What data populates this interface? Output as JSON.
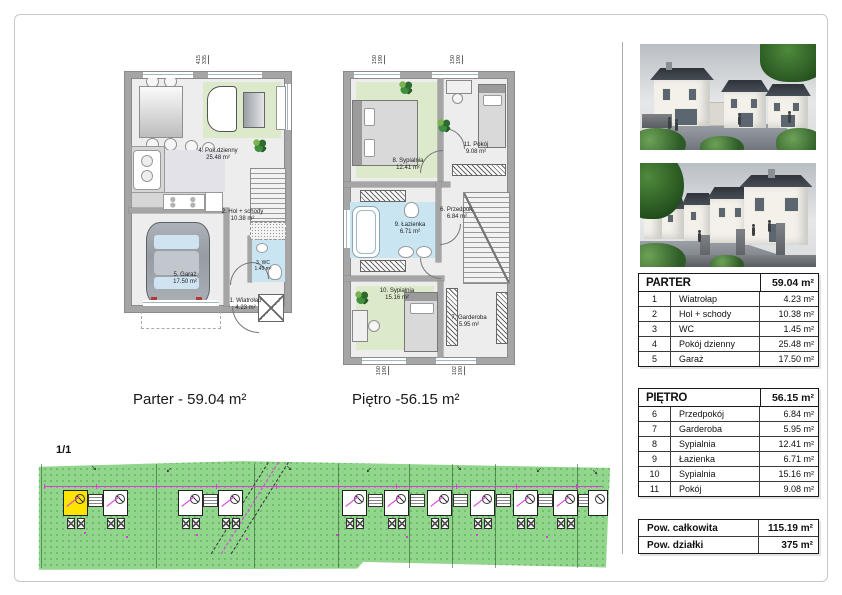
{
  "captions": {
    "parter": "Parter - 59.04 m²",
    "pietro": "Piętro -56.15 m²"
  },
  "site_plan": {
    "sheet_label": "1/1"
  },
  "plan_labels": {
    "parter": [
      {
        "name": "4. Pok.dzienny",
        "area": "25.48 m²"
      },
      {
        "name": "2. Hol + schody",
        "area": "10.38 m²"
      },
      {
        "name": "3. WC",
        "area": "1.45 m²"
      },
      {
        "name": "5. Garaż",
        "area": "17.50 m²"
      },
      {
        "name": "1. Wiatrołap",
        "area": "4.23 m²"
      }
    ],
    "pietro": [
      {
        "name": "8. Sypialnia",
        "area": "12.41 m²"
      },
      {
        "name": "11. Pokój",
        "area": "9.08 m²"
      },
      {
        "name": "9. Łazienka",
        "area": "6.71 m²"
      },
      {
        "name": "6. Przedpok.",
        "area": "6.84 m²"
      },
      {
        "name": "10. Sypialnia",
        "area": "15.16 m²"
      },
      {
        "name": "7. Garderoba",
        "area": "5.95 m²"
      }
    ]
  },
  "dimensions": {
    "parter_top": {
      "a": "415",
      "b": "335"
    },
    "pietro_top_1": {
      "a": "150",
      "b": "190"
    },
    "pietro_top_2": {
      "a": "150",
      "b": "190"
    },
    "pietro_bottom_1": {
      "a": "150",
      "b": "190"
    },
    "pietro_bottom_2": {
      "a": "102",
      "b": "190"
    }
  },
  "tables": {
    "parter": {
      "title": "PARTER",
      "total": "59.04 m²",
      "rows": [
        {
          "no": "1",
          "name": "Wiatrołap",
          "area": "4.23 m²"
        },
        {
          "no": "2",
          "name": "Hol + schody",
          "area": "10.38 m²"
        },
        {
          "no": "3",
          "name": "WC",
          "area": "1.45 m²"
        },
        {
          "no": "4",
          "name": "Pokój dzienny",
          "area": "25.48 m²"
        },
        {
          "no": "5",
          "name": "Garaż",
          "area": "17.50 m²"
        }
      ]
    },
    "pietro": {
      "title": "PIĘTRO",
      "total": "56.15 m²",
      "rows": [
        {
          "no": "6",
          "name": "Przedpokój",
          "area": "6.84 m²"
        },
        {
          "no": "7",
          "name": "Garderoba",
          "area": "5.95 m²"
        },
        {
          "no": "8",
          "name": "Sypialnia",
          "area": "12.41 m²"
        },
        {
          "no": "9",
          "name": "Łazienka",
          "area": "6.71 m²"
        },
        {
          "no": "10",
          "name": "Sypialnia",
          "area": "15.16 m²"
        },
        {
          "no": "11",
          "name": "Pokój",
          "area": "9.08 m²"
        }
      ]
    },
    "summary": {
      "rows": [
        {
          "name": "Pow. całkowita",
          "area": "115.19 m²"
        },
        {
          "name": "Pow. działki",
          "area": "375 m²"
        }
      ]
    }
  },
  "colors": {
    "site_green": "#92d68e",
    "highlight_yellow": "#ffe400",
    "annotation_magenta": "#e03ae0",
    "bath_blue": "#c9e5f2",
    "rug_green": "#dce9cb",
    "wall_gray": "#a5a5a5",
    "table_border": "#1a1a1a"
  }
}
